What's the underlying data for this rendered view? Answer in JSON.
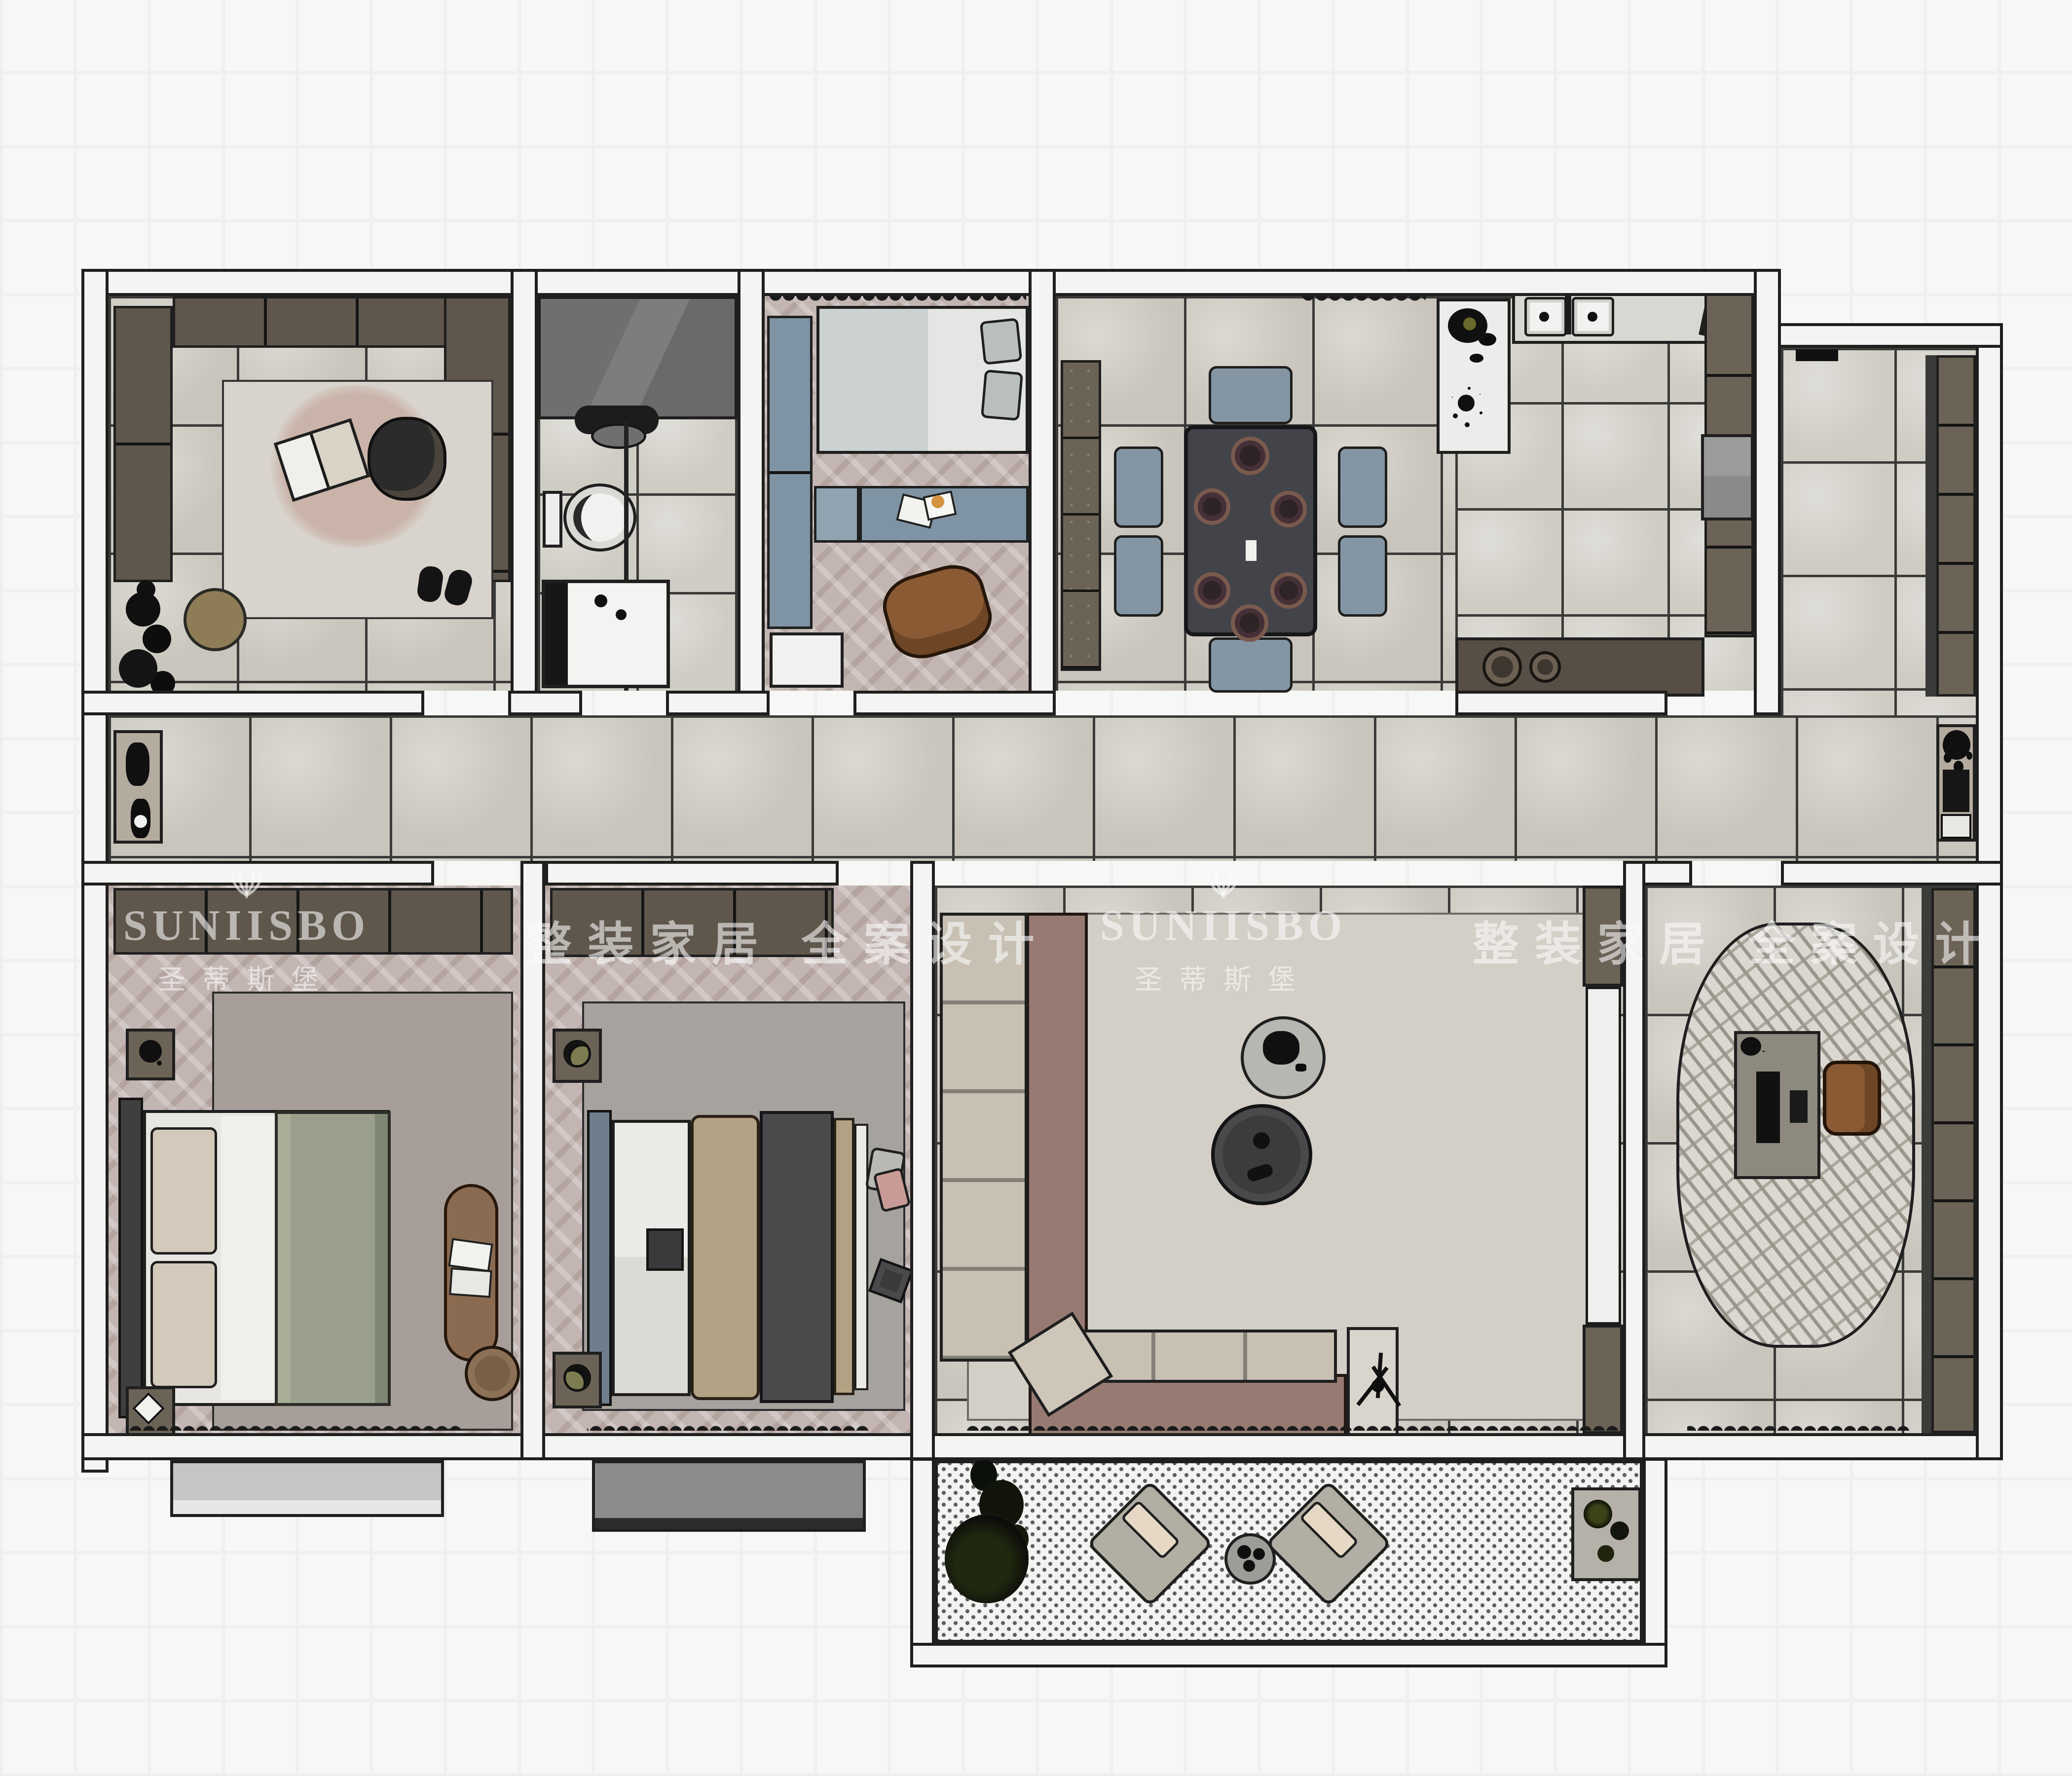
{
  "watermarks": {
    "brand_latin": "SUNIISBO",
    "brand_cn": "圣蒂斯堡",
    "slogan": "整装家居 全案设计"
  },
  "palette": {
    "line": "#1f1f1f",
    "wall": "#f4f4f2",
    "marble": "#c9c5bc",
    "marble2": "#cfccc4",
    "grout": "#3a3a38",
    "herr": "#c3b6b2",
    "cabdark": "#5f574c",
    "cabdark2": "#6c6357",
    "cabblue": "#7e93a3",
    "chairblue": "#8496a3",
    "tabledark": "#434449",
    "mauve": "#977b72",
    "cushion": "#c7c0b3",
    "ruglight": "#d3cfc6",
    "rugmaster": "#a79e99",
    "ruggray": "#a6a39f",
    "rugstudy": "#dbd8d1",
    "olive": "#9aa08b",
    "tan": "#b3a183",
    "darkblanket": "#4a4a4c",
    "wood": "#8a5a35",
    "bench": "#8a6a50",
    "counter": "#d8d7d2",
    "countertop": "#574f45",
    "matwhite": "#ececea",
    "pink": "#c99b96",
    "dot": "#5c5c5c",
    "bump_light": "#c6c6c4",
    "bump_dark": "#8b8b89",
    "watermark": "rgba(252,252,252,0.58)"
  },
  "rooms": [
    "cloakroom-lounge",
    "bathroom",
    "kids-bedroom",
    "dining-room",
    "kitchen",
    "utility-balcony",
    "hallway",
    "master-bedroom",
    "second-bedroom",
    "living-room",
    "study",
    "south-balcony"
  ],
  "furniture": {
    "cloakroom_lounge": [
      "wardrobe-cabinets",
      "area-rug",
      "armchair",
      "open-book",
      "slippers",
      "round-ottoman",
      "floor-plants"
    ],
    "bathroom": [
      "stone-vanity",
      "faucet-and-basin",
      "toilet",
      "shower-tray",
      "glass-partition"
    ],
    "kids_bedroom": [
      "blue-wardrobe",
      "single-bed",
      "pillows",
      "blue-desk",
      "papers",
      "bean-bag",
      "window-curtain"
    ],
    "dining_room": [
      "sideboard",
      "dining-table",
      "six-plates",
      "six-chairs",
      "decor-mat-with-plants"
    ],
    "kitchen": [
      "double-sink-counter",
      "cutting-board",
      "burner-counter",
      "tall-cabinets",
      "fridge"
    ],
    "hallway": [
      "console-with-plant-left",
      "console-with-plant-right"
    ],
    "master_bedroom": [
      "wardrobe",
      "double-bed",
      "pillows",
      "olive-blanket",
      "area-rug",
      "nightstands",
      "foot-bench",
      "magazines",
      "pouf",
      "window-curtain"
    ],
    "second_bedroom": [
      "wardrobe",
      "double-bed",
      "tan-blanket",
      "dark-blanket",
      "area-rug",
      "nightstands",
      "cushions",
      "window-curtain"
    ],
    "living_room": [
      "l-shaped-sofa",
      "seat-cushions",
      "round-coffee-table-light",
      "round-coffee-table-dark",
      "floor-lamp",
      "tv-media-wall",
      "area-rug",
      "window-curtain"
    ],
    "study": [
      "bookshelf-wall",
      "round-striped-rug",
      "desk",
      "laptop",
      "desk-chair",
      "window-curtain"
    ],
    "south_balcony": [
      "large-plant",
      "two-lounge-chairs",
      "side-table",
      "plant-mat"
    ],
    "utility_balcony": [
      "storage-shelf-column"
    ]
  }
}
